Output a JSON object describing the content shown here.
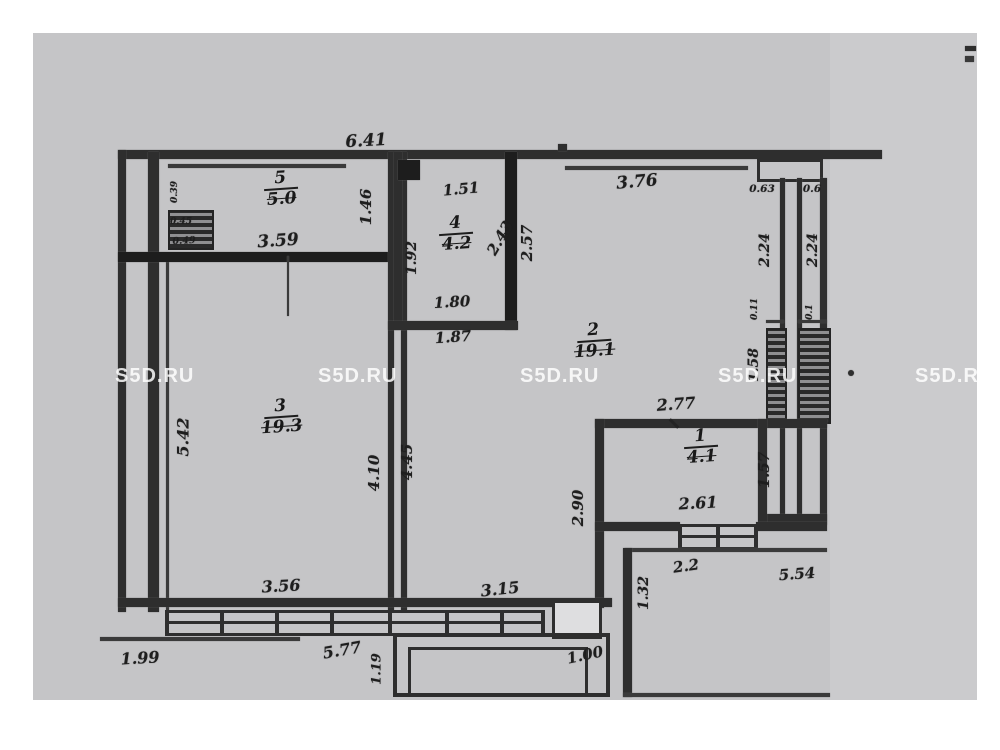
{
  "watermark": {
    "text": "S5D.RU",
    "color": "#e2e2e2"
  },
  "plan": {
    "rooms": {
      "room5": {
        "number": "5",
        "area": "5.0"
      },
      "room4": {
        "number": "4",
        "area": "4.2"
      },
      "room3": {
        "number": "3",
        "area": "19.3"
      },
      "room2": {
        "number": "2",
        "area": "19.1"
      },
      "room1": {
        "number": "1",
        "area": "4.1"
      }
    },
    "dims": {
      "d641": "6.41",
      "d376": "3.76",
      "d063": "0.63",
      "d06": "0.6",
      "d359": "3.59",
      "d151": "1.51",
      "d180": "1.80",
      "d187": "1.87",
      "d277": "2.77",
      "d261": "2.61",
      "d356": "3.56",
      "d315": "3.15",
      "d22": "2.2",
      "d554": "5.54",
      "d577": "5.77",
      "d199": "1.99",
      "d100": "1.00",
      "d039": "0.39",
      "d045": "0.45",
      "d049": "0.49",
      "d146": "1.46",
      "d192": "1.92",
      "d243": "2.43",
      "d257": "2.57",
      "d224a": "2.24",
      "d224b": "2.24",
      "d011": "0.11",
      "d01": "0.1",
      "d158": "1.58",
      "d157": "1.57",
      "d542": "5.42",
      "d410": "4.10",
      "d445": "4.45",
      "d290": "2.90",
      "d132": "1.32",
      "d119": "1.19"
    }
  }
}
